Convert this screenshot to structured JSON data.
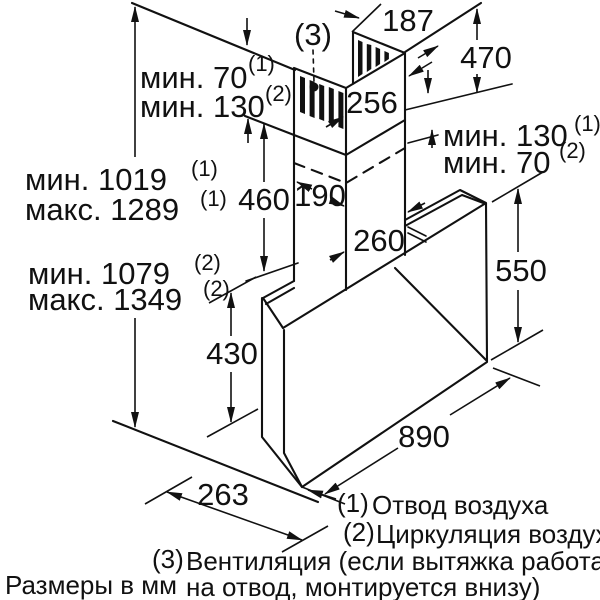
{
  "figure": {
    "units_note": "Размеры в мм",
    "dims": {
      "w187": "187",
      "h470": "470",
      "w256": "256",
      "d190": "190",
      "w260": "260",
      "h460": "460",
      "h550": "550",
      "h430": "430",
      "d263": "263",
      "w890": "890"
    },
    "annotations": {
      "ceil_min1": {
        "text": "мин. 70",
        "sup": "(1)"
      },
      "ceil_min2": {
        "text": "мин. 130",
        "sup": "(2)"
      },
      "right_min1": {
        "text": "мин. 130",
        "sup": "(1)"
      },
      "right_min2": {
        "text": "мин. 70",
        "sup": "(2)"
      },
      "left_min1": {
        "text": "мин. 1019",
        "sup": "(1)"
      },
      "left_max1": {
        "text": "макс. 1289",
        "sup": "(1)"
      },
      "left_min2": {
        "text": "мин. 1079",
        "sup": "(2)"
      },
      "left_max2": {
        "text": "макс. 1349",
        "sup": "(2)"
      },
      "callout3": "(3)"
    },
    "legend": {
      "items": [
        {
          "num": "(1)",
          "text": "Отвод воздуха"
        },
        {
          "num": "(2)",
          "text": "Циркуляция воздуха"
        },
        {
          "num": "(3)",
          "text_line1": "Вентиляция (если вытяжка работает",
          "text_line2": "на отвод, монтируется внизу)"
        }
      ]
    },
    "colors": {
      "line": "#111111",
      "background": "#ffffff"
    }
  }
}
